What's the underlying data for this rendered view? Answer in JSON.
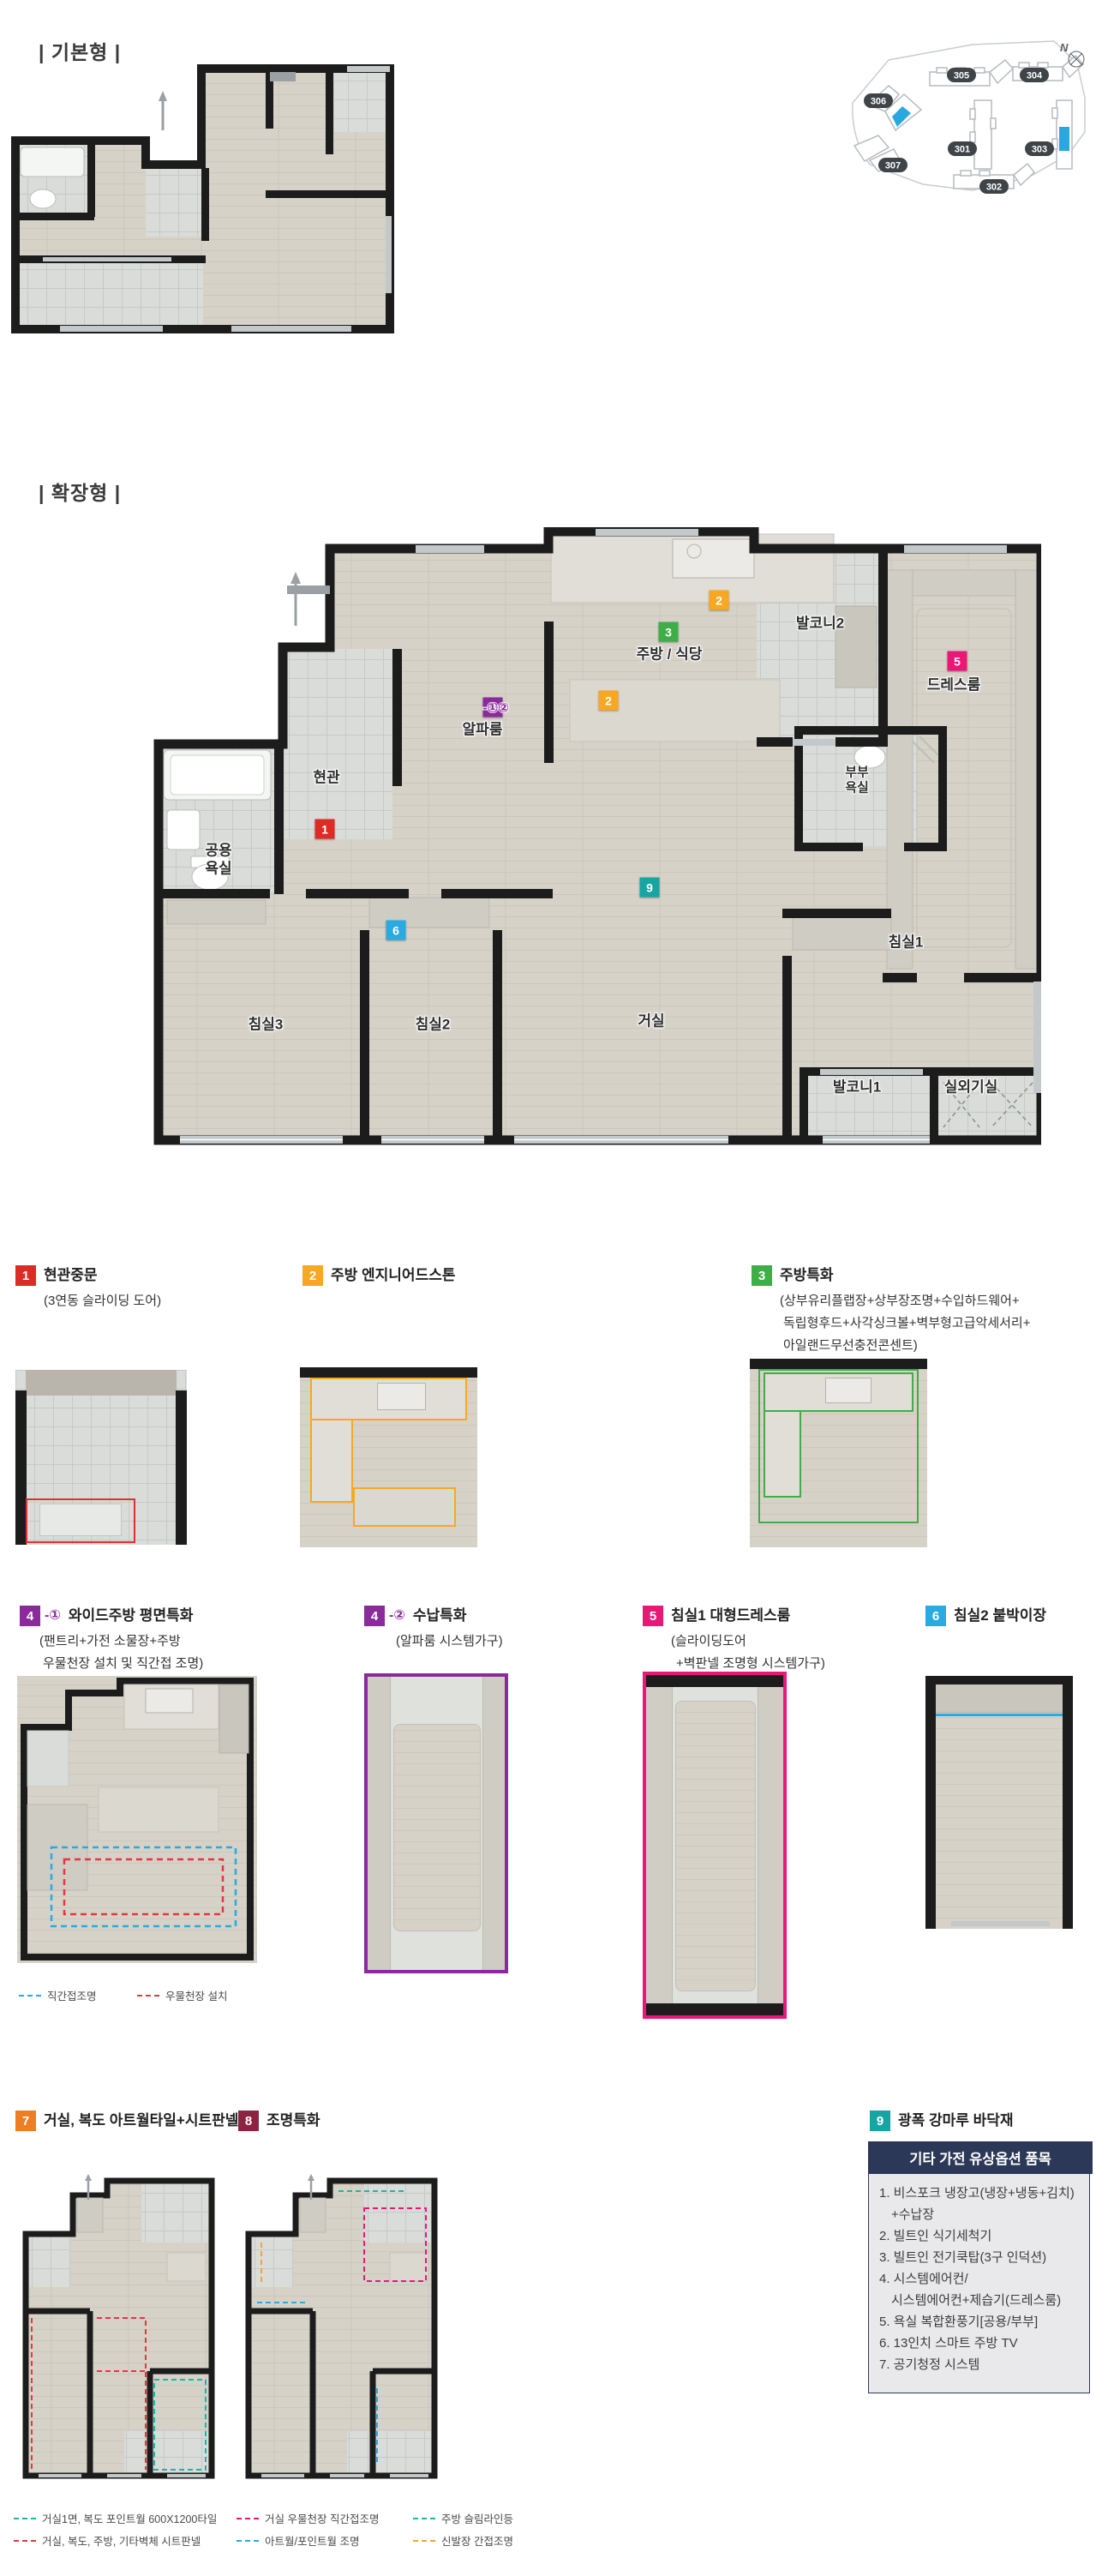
{
  "basic_section": {
    "label": "| 기본형 |"
  },
  "extended_section": {
    "label": "| 확장형 |"
  },
  "site_map": {
    "north": "N",
    "buildings": [
      {
        "no": "306"
      },
      {
        "no": "305"
      },
      {
        "no": "304"
      },
      {
        "no": "307"
      },
      {
        "no": "301"
      },
      {
        "no": "303"
      },
      {
        "no": "302"
      }
    ]
  },
  "plan_rooms": {
    "entrance": "현관",
    "bath_common": "공용\n욕실",
    "alpha": "알파룸",
    "kitchen": "주방 / 식당",
    "balcony2": "발코니2",
    "dress": "드레스룸",
    "bath_master": "부부\n욕실",
    "bed1": "침실1",
    "bed2": "침실2",
    "bed3": "침실3",
    "living": "거실",
    "balcony1": "발코니1",
    "outdoor": "실외기실"
  },
  "plan_badges": {
    "n1": "1",
    "n2a": "2",
    "n2b": "2",
    "n3": "3",
    "n4": "4",
    "n4_sub": "-①②",
    "n5": "5",
    "n6": "6",
    "n9": "9"
  },
  "callouts": [
    {
      "num": "1",
      "title": "현관중문",
      "sub1": "(3연동 슬라이딩 도어)"
    },
    {
      "num": "2",
      "title": "주방 엔지니어드스톤"
    },
    {
      "num": "3",
      "title": "주방특화",
      "sub1": "(상부유리플랩장+상부장조명+수입하드웨어+",
      "sub2": "독립형후드+사각싱크볼+벽부형고급악세서리+",
      "sub3": "아일랜드무선충전콘센트)"
    },
    {
      "num": "4",
      "numsub": "-①",
      "title": "와이드주방 평면특화",
      "sub1": "(팬트리+가전 소물장+주방",
      "sub2": "우물천장 설치 및 직간접 조명)"
    },
    {
      "num": "4",
      "numsub": "-②",
      "title": "수납특화",
      "sub1": "(알파룸 시스템가구)"
    },
    {
      "num": "5",
      "title": "침실1 대형드레스룸",
      "sub1": "(슬라이딩도어",
      "sub2": "+벽판넬 조명형 시스템가구)"
    },
    {
      "num": "6",
      "title": "침실2 붙박이장"
    },
    {
      "num": "7",
      "title": "거실, 복도 아트월타일+시트판넬"
    },
    {
      "num": "8",
      "title": "조명특화"
    },
    {
      "num": "9",
      "title": "광폭 강마루 바닥재"
    }
  ],
  "legends": {
    "row2_a": "직간접조명",
    "row2_b": "우물천장 설치",
    "item7_a": "거실1면, 복도 포인트월 600X1200타일",
    "item7_b": "거실, 복도, 주방, 기타벽체 시트판넬",
    "item8_a": "거실 우물천장 직간접조명",
    "item8_b": "아트월/포인트월 조명",
    "item8_c": "주방 슬림라인등",
    "item8_d": "신발장 간접조명"
  },
  "options_box": {
    "title": "기타 가전 유상옵션 품목",
    "items": [
      {
        "l1": "1. 비스포크 냉장고(냉장+냉동+김치)",
        "l2": "+수납장"
      },
      {
        "l1": "2. 빌트인 식기세척기"
      },
      {
        "l1": "3. 빌트인 전기쿡탑(3구 인덕션)"
      },
      {
        "l1": "4. 시스템에어컨/",
        "l2": "시스템에어컨+제습기(드레스룸)"
      },
      {
        "l1": "5. 욕실 복합환풍기[공용/부부]"
      },
      {
        "l1": "6. 13인치 스마트 주방 TV"
      },
      {
        "l1": "7. 공기청정 시스템"
      }
    ]
  },
  "colors": {
    "badge_red": "#dd2b26",
    "badge_orange": "#f7a823",
    "badge_green": "#3fae49",
    "badge_purple": "#8a2a9b",
    "badge_pink": "#ea1777",
    "badge_blue": "#29abe2",
    "badge_teal": "#16a5a3",
    "badge_orange_deep": "#ef7d22",
    "badge_maroon": "#8c2341",
    "navy_box": "#2b3857",
    "site_highlight": "#29a8e0",
    "wall": "#1c1c1c",
    "wood_floor": "#d6d2c8",
    "tile_floor": "#d9dcd8",
    "legend_teal": "#1ab5ad",
    "legend_red": "#e8353f",
    "legend_magenta": "#ea1777",
    "legend_blue": "#29abe2",
    "legend_orange": "#f5a623"
  }
}
